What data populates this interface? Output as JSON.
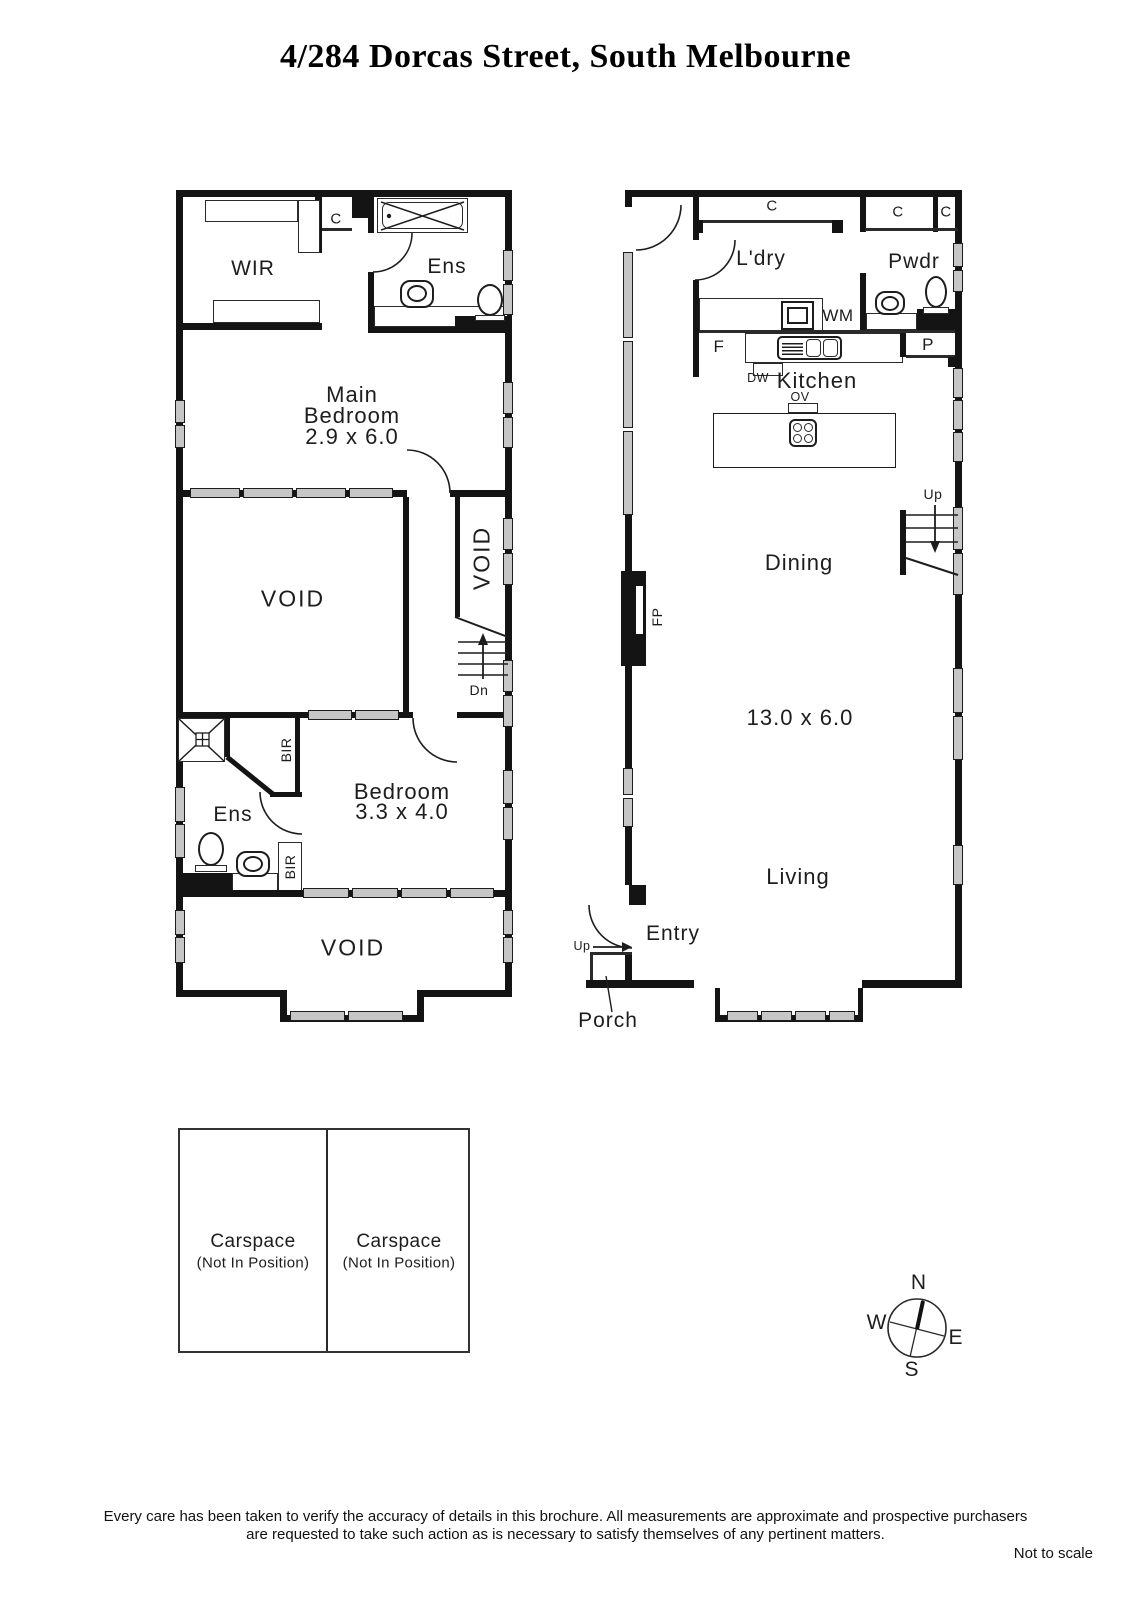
{
  "title": "4/284 Dorcas Street, South Melbourne",
  "upper_plan": {
    "wir": "WIR",
    "cupboard": "C",
    "ens_top": "Ens",
    "main_bedroom_line1": "Main",
    "main_bedroom_line2": "Bedroom",
    "main_bedroom_dims": "2.9 x 6.0",
    "void_main": "VOID",
    "void_side": "VOID",
    "dn": "Dn",
    "bir_upper": "BIR",
    "bir_lower": "BIR",
    "ens_lower": "Ens",
    "bedroom_line1": "Bedroom",
    "bedroom_dims": "3.3 x 4.0",
    "void_lower": "VOID"
  },
  "ground_plan": {
    "cupboard_band": "C",
    "cupboard_right1": "C",
    "cupboard_right2": "C",
    "laundry": "L'dry",
    "powder": "Pwdr",
    "washing_machine": "WM",
    "fridge": "F",
    "pantry": "P",
    "dishwasher": "DW",
    "kitchen": "Kitchen",
    "oven": "OV",
    "fireplace": "FP",
    "up_stairs": "Up",
    "dining": "Dining",
    "dimensions": "13.0 x 6.0",
    "living": "Living",
    "entry": "Entry",
    "up_entry": "Up",
    "porch": "Porch"
  },
  "carspaces": [
    {
      "name": "Carspace",
      "note": "(Not In Position)"
    },
    {
      "name": "Carspace",
      "note": "(Not In Position)"
    }
  ],
  "compass": {
    "n": "N",
    "s": "S",
    "e": "E",
    "w": "W"
  },
  "footer": {
    "disclaimer_line1": "Every care has been taken to verify the accuracy of details in this brochure.  All measurements are approximate and prospective purchasers",
    "disclaimer_line2": "are requested to take such action as is necessary to satisfy themselves of any pertinent matters.",
    "scale_note": "Not to scale"
  }
}
